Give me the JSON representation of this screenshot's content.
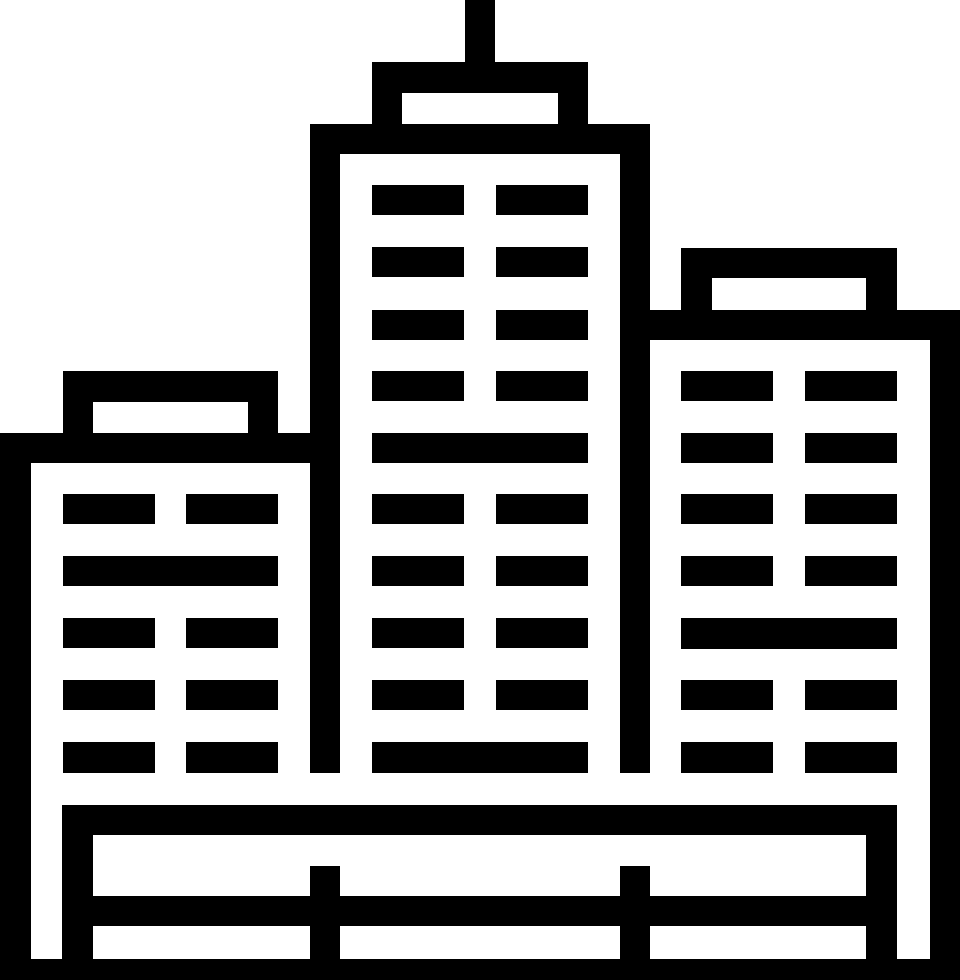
{
  "icon": {
    "description": "city-buildings-skyline-icon",
    "canvas": {
      "width": 960,
      "height": 980
    },
    "colors": {
      "fill": "#000000",
      "background": "#ffffff"
    },
    "parts": [
      {
        "name": "antenna-mast",
        "rects": [
          [
            465,
            0,
            30,
            93
          ]
        ]
      },
      {
        "name": "center-building",
        "rects": [
          [
            372,
            62,
            216,
            31
          ],
          [
            372,
            93,
            30,
            31
          ],
          [
            558,
            93,
            30,
            31
          ],
          [
            310,
            124,
            340,
            30
          ],
          [
            310,
            154,
            30,
            619
          ],
          [
            620,
            154,
            30,
            619
          ],
          [
            372,
            185,
            92,
            30
          ],
          [
            496,
            185,
            92,
            30
          ],
          [
            372,
            247,
            92,
            30
          ],
          [
            496,
            247,
            92,
            30
          ],
          [
            372,
            310,
            92,
            30
          ],
          [
            496,
            310,
            92,
            30
          ],
          [
            372,
            371,
            92,
            30
          ],
          [
            496,
            371,
            92,
            30
          ],
          [
            372,
            433,
            216,
            30
          ],
          [
            372,
            494,
            92,
            30
          ],
          [
            496,
            494,
            92,
            30
          ],
          [
            372,
            556,
            92,
            30
          ],
          [
            496,
            556,
            92,
            30
          ],
          [
            372,
            618,
            92,
            30
          ],
          [
            496,
            618,
            92,
            30
          ],
          [
            372,
            680,
            92,
            30
          ],
          [
            496,
            680,
            92,
            30
          ],
          [
            372,
            742,
            216,
            31
          ]
        ]
      },
      {
        "name": "left-building",
        "rects": [
          [
            63,
            371,
            215,
            31
          ],
          [
            63,
            402,
            30,
            31
          ],
          [
            248,
            402,
            30,
            31
          ],
          [
            0,
            433,
            310,
            30
          ],
          [
            0,
            463,
            31,
            496
          ],
          [
            63,
            494,
            92,
            30
          ],
          [
            186,
            494,
            92,
            30
          ],
          [
            63,
            556,
            215,
            30
          ],
          [
            63,
            618,
            92,
            30
          ],
          [
            186,
            618,
            92,
            30
          ],
          [
            63,
            680,
            92,
            30
          ],
          [
            186,
            680,
            92,
            30
          ],
          [
            63,
            742,
            92,
            31
          ],
          [
            186,
            742,
            92,
            31
          ]
        ]
      },
      {
        "name": "right-building",
        "rects": [
          [
            681,
            248,
            216,
            30
          ],
          [
            681,
            278,
            31,
            32
          ],
          [
            866,
            278,
            31,
            32
          ],
          [
            650,
            310,
            310,
            30
          ],
          [
            930,
            340,
            30,
            640
          ],
          [
            681,
            371,
            92,
            30
          ],
          [
            805,
            371,
            92,
            30
          ],
          [
            681,
            433,
            92,
            30
          ],
          [
            805,
            433,
            92,
            30
          ],
          [
            681,
            494,
            92,
            30
          ],
          [
            805,
            494,
            92,
            30
          ],
          [
            681,
            556,
            92,
            30
          ],
          [
            805,
            556,
            92,
            30
          ],
          [
            681,
            618,
            216,
            31
          ],
          [
            681,
            680,
            92,
            30
          ],
          [
            805,
            680,
            92,
            30
          ],
          [
            681,
            742,
            92,
            31
          ],
          [
            805,
            742,
            92,
            31
          ]
        ]
      },
      {
        "name": "base-fence",
        "rects": [
          [
            62,
            805,
            835,
            30
          ],
          [
            62,
            805,
            31,
            154
          ],
          [
            866,
            835,
            31,
            124
          ],
          [
            62,
            896,
            835,
            30
          ],
          [
            310,
            866,
            30,
            93
          ],
          [
            620,
            866,
            30,
            93
          ],
          [
            0,
            959,
            960,
            21
          ]
        ]
      }
    ]
  }
}
